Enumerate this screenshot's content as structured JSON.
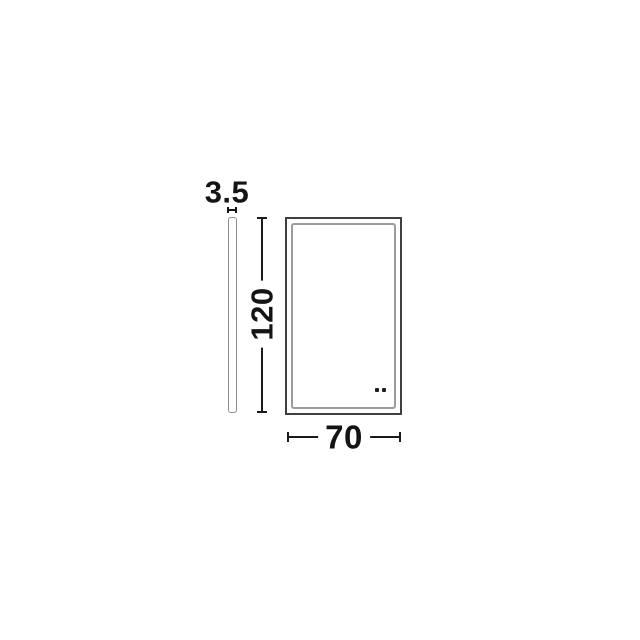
{
  "drawing": {
    "title": "mirror-dimension-drawing",
    "side_profile": {
      "thickness_label": "3.5"
    },
    "front_view": {
      "height_label": "120",
      "width_label": "70",
      "touch_sensor_dot_count": 2
    },
    "colors": {
      "background": "#ffffff",
      "dimension_line": "#1a1a1a",
      "outer_outline": "#3f3f3f",
      "inner_frame_outline": "#9c9c9c",
      "side_profile_outline": "#8f8f8f",
      "text": "#141414"
    }
  }
}
